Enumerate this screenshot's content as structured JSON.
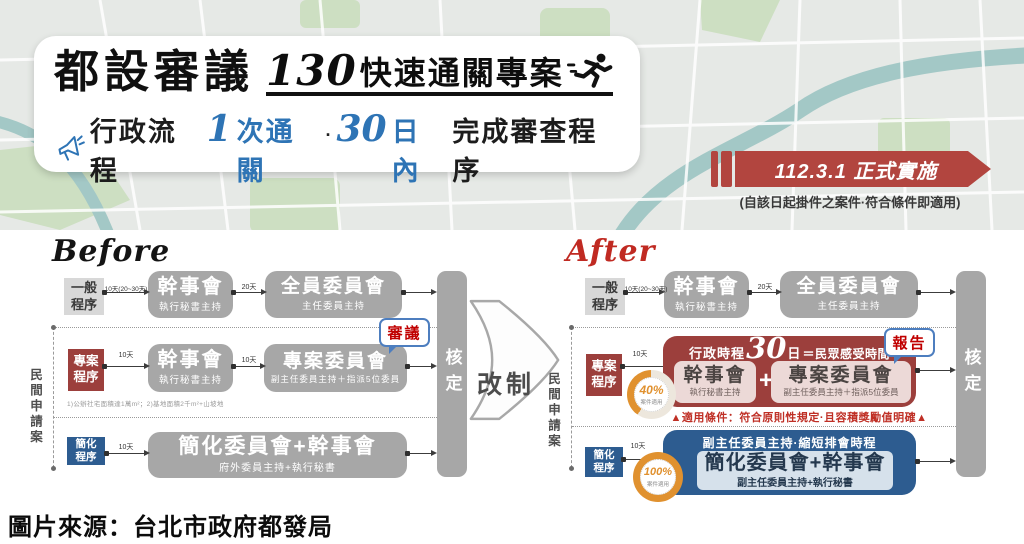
{
  "colors": {
    "banner_red": "#b2453f",
    "project_red": "#9c3f3c",
    "simplified_blue": "#2d5c90",
    "accent_blue": "#2e74b5",
    "flow_gray": "#a7a7a7",
    "donut_orange": "#e0912f",
    "bubble_border_blue": "#4d7ebf",
    "bubble_text_red": "#c00000"
  },
  "header": {
    "title": "都設審議",
    "program_number": "130",
    "program_name": "快速通關專案",
    "tagline": {
      "prefix": "行政流程",
      "num1": "1",
      "text1": "次通關",
      "dot": "·",
      "num2": "30",
      "text2": "日內",
      "suffix": "完成審查程序"
    }
  },
  "banner": {
    "title": "112.3.1 正式實施",
    "note": "(自該日起掛件之案件·符合條件即適用)"
  },
  "transition": {
    "label": "改制"
  },
  "before": {
    "title": "Before",
    "applicant": "民間申請案",
    "approval": "核定",
    "general": {
      "label": "一般\n程序",
      "t1": "10天(20~30天)",
      "box1": {
        "title": "幹事會",
        "sub": "執行秘書主持"
      },
      "t2": "20天",
      "box2": {
        "title": "全員委員會",
        "sub": "主任委員主持"
      }
    },
    "project": {
      "label": "專案\n程序",
      "t1": "10天",
      "box1": {
        "title": "幹事會",
        "sub": "執行秘書主持"
      },
      "t2": "10天",
      "box2": {
        "title": "專案委員會",
        "sub": "副主任委員主持＋指派5位委員"
      },
      "bubble": "審議",
      "footnote": "1)公辦社宅面積達1萬m²；2)基地面積2千m²+山坡地"
    },
    "simplified": {
      "label": "簡化\n程序",
      "t1": "10天",
      "box": {
        "title": "簡化委員會+幹事會",
        "sub": "府外委員主持+執行秘書"
      }
    }
  },
  "after": {
    "title": "After",
    "applicant": "民間申請案",
    "approval": "核定",
    "general": {
      "label": "一般\n程序",
      "t1": "10天(20~30天)",
      "box1": {
        "title": "幹事會",
        "sub": "執行秘書主持"
      },
      "t2": "20天",
      "box2": {
        "title": "全員委員會",
        "sub": "主任委員主持"
      }
    },
    "project": {
      "label": "專案\n程序",
      "t1": "10天",
      "donut": {
        "pct": "40%",
        "label": "案件適用"
      },
      "head": {
        "prefix": "行政時程",
        "num": "30",
        "day": "日",
        "suffix": "＝民眾感受時間"
      },
      "box1": {
        "title": "幹事會",
        "sub": "執行秘書主持"
      },
      "plus": "+",
      "box2": {
        "title": "專案委員會",
        "sub": "副主任委員主持＋指派5位委員"
      },
      "bubble": "報告",
      "condition": "▲適用條件：符合原則性規定·且容積獎勵值明確▲"
    },
    "simplified": {
      "label": "簡化\n程序",
      "t1": "10天",
      "donut": {
        "pct": "100%",
        "label": "案件適用"
      },
      "head": "副主任委員主持·縮短排會時程",
      "box": {
        "title": "簡化委員會+幹事會",
        "sub": "副主任委員主持+執行秘書"
      }
    }
  },
  "caption": "圖片來源：台北市政府都發局"
}
